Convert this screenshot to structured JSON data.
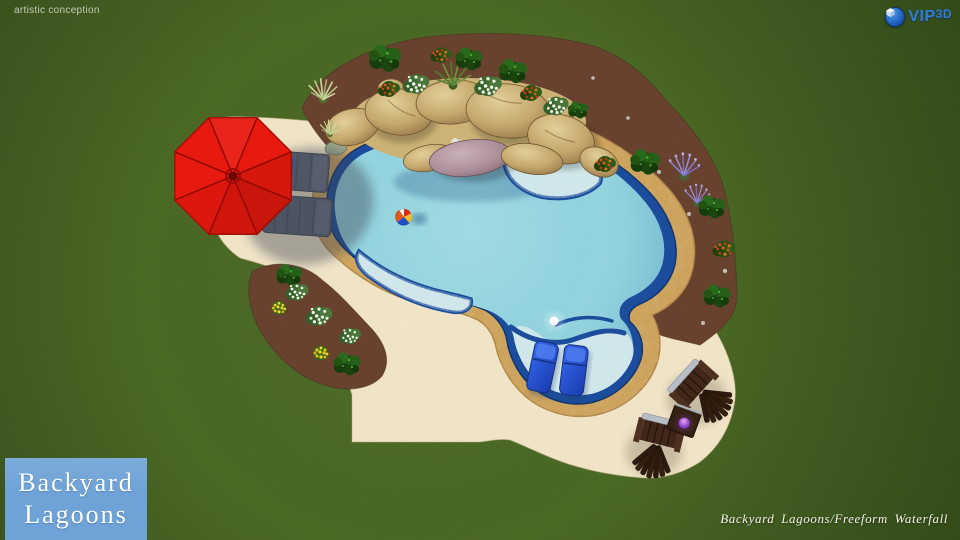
{
  "watermark": {
    "text": "artistic conception"
  },
  "branding": {
    "vip3d": {
      "prefix": "VIP",
      "suffix": "3D",
      "icon": "cube-3d-badge"
    },
    "logo": {
      "line1": "Backyard",
      "line2": "Lagoons"
    },
    "caption": "Backyard Lagoons/Freeform Waterfall"
  },
  "palette": {
    "grass": "#4c6d28",
    "patio": "#f2e6c8",
    "mulch": "#6b4533",
    "coping": "#d7ac63",
    "pool_tile": "#1c4d9c",
    "water": "#8bd5df",
    "shelf_water": "#cde7ea",
    "umbrella_red": "#e8190e",
    "lounger_blue": "#2353d6",
    "chair_brown": "#40271a",
    "logo_bg": "#6fa3d7",
    "logo_text": "#ffffff",
    "vip_blue": "#2d7ce0",
    "caption_color": "#f7f4ea"
  }
}
